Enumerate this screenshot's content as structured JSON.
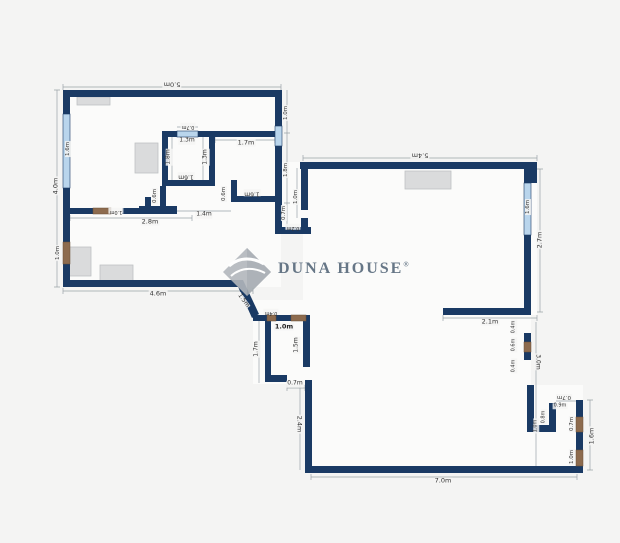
{
  "watermark": {
    "display": "Duna House",
    "registered": "®"
  },
  "colors": {
    "background": "#f4f4f3",
    "floor": "#fbfbfa",
    "wall": "#1a3a64",
    "window": "#b9d5ec",
    "door": "#8d6b4e",
    "furniture": "#dadbdc",
    "dimension": "#9aa2a8",
    "label_text": "#333333",
    "watermark_text": "#56687a",
    "watermark_diamond": "#b2b7bc"
  },
  "dimension_labels": [
    {
      "t": "5.0m",
      "x": 172,
      "y": 84,
      "r": 180,
      "s": 6.5
    },
    {
      "t": "4.0m",
      "x": 56,
      "y": 186,
      "r": -90,
      "s": 6.5
    },
    {
      "t": "1.6m",
      "x": 68,
      "y": 149,
      "r": -90,
      "s": 5.5
    },
    {
      "t": "1.0m",
      "x": 58,
      "y": 253,
      "r": -90,
      "s": 5.5
    },
    {
      "t": "2.8m",
      "x": 150,
      "y": 222,
      "r": 0,
      "s": 6.5
    },
    {
      "t": "1.0m",
      "x": 116,
      "y": 211,
      "r": 180,
      "s": 5
    },
    {
      "t": "0.7m",
      "x": 188,
      "y": 126,
      "r": 180,
      "s": 5
    },
    {
      "t": "1.3m",
      "x": 187,
      "y": 141,
      "r": 0,
      "s": 6
    },
    {
      "t": "1.8m",
      "x": 169,
      "y": 157,
      "r": -90,
      "s": 6
    },
    {
      "t": "1.3m",
      "x": 206,
      "y": 157,
      "r": -90,
      "s": 6
    },
    {
      "t": "1.6m",
      "x": 186,
      "y": 176,
      "r": 180,
      "s": 6
    },
    {
      "t": "0.6m",
      "x": 155,
      "y": 196,
      "r": -90,
      "s": 5.5
    },
    {
      "t": "0.6m",
      "x": 224,
      "y": 194,
      "r": -90,
      "s": 5.5
    },
    {
      "t": "1.4m",
      "x": 204,
      "y": 215,
      "r": 0,
      "s": 6
    },
    {
      "t": "1.7m",
      "x": 246,
      "y": 143,
      "r": 0,
      "s": 6.5
    },
    {
      "t": "1.6m",
      "x": 252,
      "y": 193,
      "r": 180,
      "s": 6
    },
    {
      "t": "1.0m",
      "x": 286,
      "y": 113,
      "r": -90,
      "s": 5.5
    },
    {
      "t": "1.8m",
      "x": 286,
      "y": 170,
      "r": -90,
      "s": 5.5
    },
    {
      "t": "0.7m",
      "x": 284,
      "y": 213,
      "r": -90,
      "s": 5.5
    },
    {
      "t": "1.0m",
      "x": 296,
      "y": 197,
      "r": -90,
      "s": 5.5
    },
    {
      "t": "0.2m",
      "x": 293,
      "y": 227,
      "r": 180,
      "s": 5
    },
    {
      "t": "5.4m",
      "x": 420,
      "y": 155,
      "r": 180,
      "s": 6.5
    },
    {
      "t": "1.6m",
      "x": 528,
      "y": 207,
      "r": -90,
      "s": 5.5
    },
    {
      "t": "2.7m",
      "x": 540,
      "y": 240,
      "r": -90,
      "s": 6.5
    },
    {
      "t": "2.1m",
      "x": 490,
      "y": 322,
      "r": 0,
      "s": 6.5
    },
    {
      "t": "0.4m",
      "x": 514,
      "y": 327,
      "r": -90,
      "s": 5
    },
    {
      "t": "0.6m",
      "x": 514,
      "y": 345,
      "r": -90,
      "s": 5
    },
    {
      "t": "0.4m",
      "x": 514,
      "y": 366,
      "r": -90,
      "s": 5
    },
    {
      "t": "3.0m",
      "x": 537,
      "y": 362,
      "r": 90,
      "s": 6
    },
    {
      "t": "0.7m",
      "x": 564,
      "y": 397,
      "r": 180,
      "s": 5.5
    },
    {
      "t": "0.9m",
      "x": 560,
      "y": 406,
      "r": 0,
      "s": 5
    },
    {
      "t": "0.8m",
      "x": 544,
      "y": 417,
      "r": -90,
      "s": 5
    },
    {
      "t": "1.0m",
      "x": 536,
      "y": 426,
      "r": -90,
      "s": 5
    },
    {
      "t": "0.7m",
      "x": 572,
      "y": 424,
      "r": -90,
      "s": 5.5
    },
    {
      "t": "1.0m",
      "x": 572,
      "y": 457,
      "r": -90,
      "s": 5.5
    },
    {
      "t": "1.6m",
      "x": 592,
      "y": 436,
      "r": -90,
      "s": 6.5
    },
    {
      "t": "7.0m",
      "x": 443,
      "y": 481,
      "r": 0,
      "s": 6.5
    },
    {
      "t": "2.4m",
      "x": 299,
      "y": 424,
      "r": 90,
      "s": 6.5
    },
    {
      "t": "0.7m",
      "x": 295,
      "y": 384,
      "r": 0,
      "s": 6
    },
    {
      "t": "1.7m",
      "x": 257,
      "y": 349,
      "r": -90,
      "s": 6
    },
    {
      "t": "1.5m",
      "x": 297,
      "y": 345,
      "r": -90,
      "s": 6
    },
    {
      "t": "1.5m",
      "x": 243,
      "y": 301,
      "r": 55,
      "s": 6
    },
    {
      "t": "0.4m",
      "x": 271,
      "y": 312,
      "r": 180,
      "s": 5
    },
    {
      "t": "1.0m",
      "x": 284,
      "y": 327,
      "r": 0,
      "s": 6.5,
      "bold": true
    },
    {
      "t": "4.6m",
      "x": 158,
      "y": 294,
      "r": 0,
      "s": 6.5
    }
  ]
}
